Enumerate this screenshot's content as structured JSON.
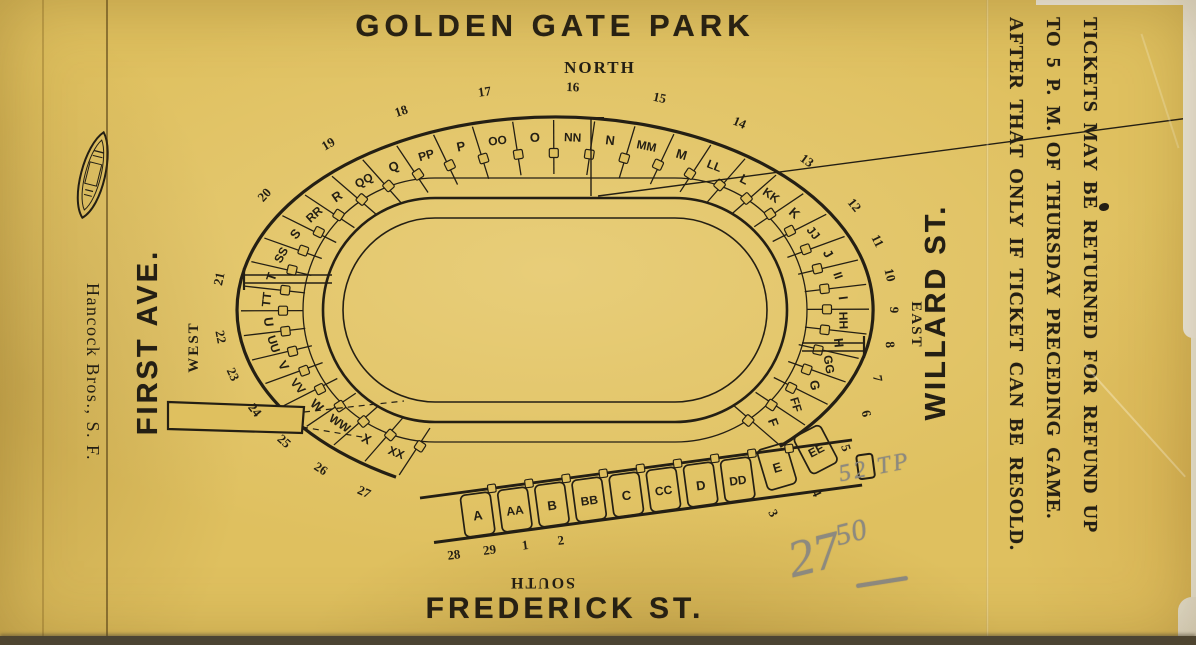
{
  "title": "GOLDEN GATE PARK",
  "compass": {
    "north": "NORTH",
    "south": "SOUTH",
    "east": "EAST",
    "west": "WEST"
  },
  "streets": {
    "west_side": "FIRST AVE.",
    "east_side": "WILLARD ST.",
    "south_side": "FREDERICK ST."
  },
  "printer": {
    "name": "Hancock Bros., S. F."
  },
  "refund_notice": {
    "lines": [
      "TICKETS MAY BE RETURNED FOR REFUND UP",
      "TO 5 P. M. OF THURSDAY PRECEDING GAME.",
      "AFTER THAT ONLY IF TICKET CAN BE RESOLD."
    ]
  },
  "pencil_annotations": {
    "note": "52 TP",
    "price_main": "27",
    "price_cents": "50"
  },
  "stadium": {
    "bowl_sections": [
      "F",
      "FF",
      "G",
      "GG",
      "H",
      "HH",
      "I",
      "II",
      "J",
      "JJ",
      "K",
      "KK",
      "L",
      "LL",
      "M",
      "MM",
      "N",
      "NN",
      "O",
      "OO",
      "P",
      "PP",
      "Q",
      "QQ",
      "R",
      "RR",
      "S",
      "SS",
      "T",
      "TT",
      "U",
      "UU",
      "V",
      "VV",
      "W",
      "WW",
      "X",
      "XX"
    ],
    "strip_sections": [
      "A",
      "AA",
      "B",
      "BB",
      "C",
      "CC",
      "D",
      "DD",
      "E",
      "EE"
    ],
    "bowl_gates": [
      "3",
      "4",
      "5",
      "6",
      "7",
      "8",
      "9",
      "10",
      "11",
      "12",
      "13",
      "14",
      "15",
      "16",
      "17",
      "18",
      "19",
      "20",
      "21",
      "22",
      "23",
      "24",
      "25",
      "26",
      "27"
    ],
    "strip_gates": [
      "28",
      "29",
      "1",
      "2"
    ]
  },
  "colors": {
    "paper": "#dfc05f",
    "ink": "#241f14",
    "pencil": "#8d8a80",
    "scan_edge": "#f1eee3",
    "scan_bed": "#46433a"
  }
}
